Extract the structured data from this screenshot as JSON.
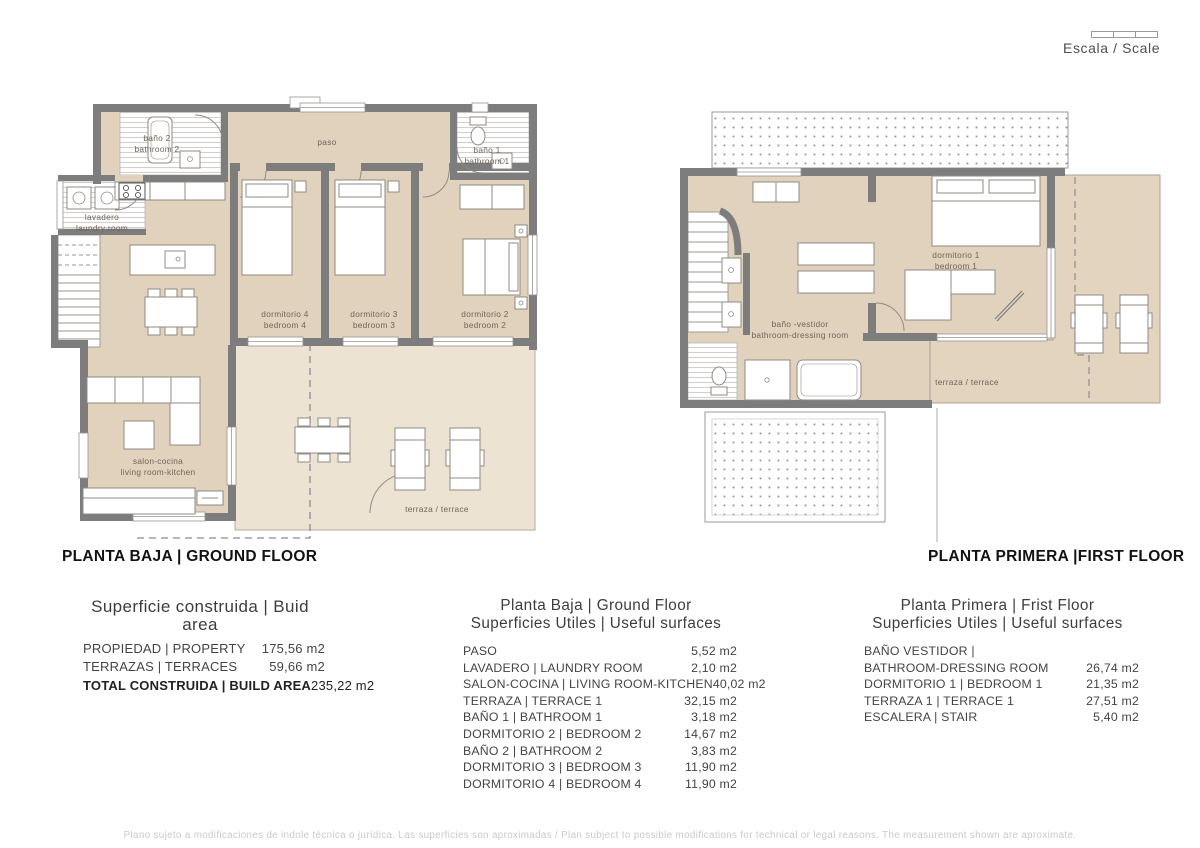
{
  "scale": {
    "label": "Escala / Scale"
  },
  "plans": {
    "ground": {
      "title": "PLANTA BAJA | GROUND FLOOR",
      "rooms": {
        "bano2": {
          "line1": "baño 2",
          "line2": "bathroom 2"
        },
        "paso": {
          "line1": "paso"
        },
        "bano1": {
          "line1": "baño 1",
          "line2": "bathroom 1"
        },
        "lavadero": {
          "line1": "lavadero",
          "line2": "laundry room"
        },
        "dorm4": {
          "line1": "dormitorio 4",
          "line2": "bedroom 4"
        },
        "dorm3": {
          "line1": "dormitorio 3",
          "line2": "bedroom 3"
        },
        "dorm2": {
          "line1": "dormitorio 2",
          "line2": "bedroom 2"
        },
        "salon": {
          "line1": "salon-cocina",
          "line2": "living room-kitchen"
        },
        "terraza": {
          "line1": "terraza / terrace"
        }
      }
    },
    "first": {
      "title": "PLANTA PRIMERA |FIRST FLOOR",
      "rooms": {
        "dorm1": {
          "line1": "dormitorio 1",
          "line2": "bedroom 1"
        },
        "banovestidor": {
          "line1": "baño -vestidor",
          "line2": "bathroom-dressing room"
        },
        "terraza": {
          "line1": "terraza / terrace"
        }
      }
    }
  },
  "tables": {
    "built": {
      "title": "Superficie construida | Buid area",
      "rows": [
        {
          "label": "PROPIEDAD | PROPERTY",
          "value": "175,56 m2"
        },
        {
          "label": "TERRAZAS | TERRACES",
          "value": "59,66 m2"
        },
        {
          "label": "TOTAL CONSTRUIDA | BUILD AREA",
          "value": "235,22 m2"
        }
      ]
    },
    "ground": {
      "title1": "Planta Baja | Ground Floor",
      "title2": "Superficies Utiles | Useful surfaces",
      "rows": [
        {
          "label": "PASO",
          "value": "5,52 m2"
        },
        {
          "label": "LAVADERO | LAUNDRY ROOM",
          "value": "2,10 m2"
        },
        {
          "label": "SALON-COCINA | LIVING ROOM-KITCHEN",
          "value": "40,02 m2"
        },
        {
          "label": "TERRAZA | TERRACE 1",
          "value": "32,15 m2"
        },
        {
          "label": "BAÑO 1 | BATHROOM 1",
          "value": "3,18 m2"
        },
        {
          "label": "DORMITORIO 2 | BEDROOM 2",
          "value": "14,67 m2"
        },
        {
          "label": "BAÑO 2 | BATHROOM 2",
          "value": "3,83 m2"
        },
        {
          "label": "DORMITORIO 3 | BEDROOM 3",
          "value": "11,90 m2"
        },
        {
          "label": "DORMITORIO 4 | BEDROOM 4",
          "value": "11,90 m2"
        }
      ]
    },
    "first": {
      "title1": "Planta Primera | Frist Floor",
      "title2": "Superficies Utiles | Useful surfaces",
      "rows": [
        {
          "label": "BAÑO VESTIDOR |",
          "value": ""
        },
        {
          "label": "BATHROOM-DRESSING ROOM",
          "value": "26,74 m2"
        },
        {
          "label": "DORMITORIO 1 | BEDROOM 1",
          "value": "21,35 m2"
        },
        {
          "label": "TERRAZA 1 | TERRACE 1",
          "value": "27,51 m2"
        },
        {
          "label": "ESCALERA | STAIR",
          "value": "5,40 m2"
        }
      ]
    }
  },
  "footer": {
    "disclaimer": "Plano sujeto a modificaciones de indole técnica o jurídica. Las superficies son aproximadas / Plan subject to possible modifications for technical or legal reasons. The measurement shown are aproximate."
  },
  "colors": {
    "floor_fill": "#e1d2bd",
    "terrace_fill": "#ece3d2",
    "wall_gray": "#7d7d7d"
  }
}
